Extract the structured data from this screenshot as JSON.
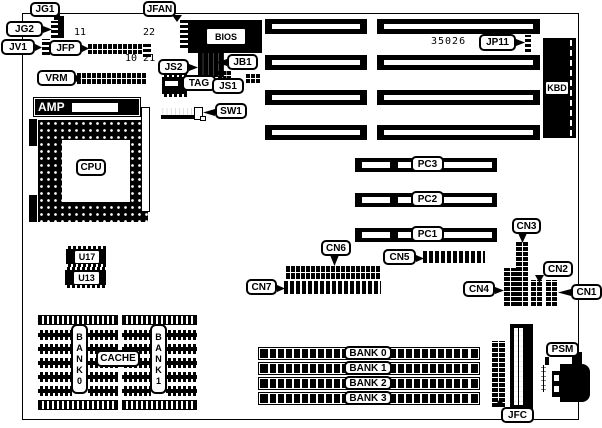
{
  "colors": {
    "ink": "#000000",
    "paper": "#ffffff"
  },
  "labels": {
    "jg1": "JG1",
    "jg2": "JG2",
    "jv1": "JV1",
    "jfp": "JFP",
    "vrm": "VRM",
    "amp": "AMP",
    "cpu": "CPU",
    "u17": "U17",
    "u13": "U13",
    "jfan": "JFAN",
    "bios": "BIOS",
    "js2": "JS2",
    "jb1": "JB1",
    "tag": "TAG",
    "js1": "JS1",
    "sw1": "SW1",
    "jp11": "JP11",
    "kbd": "KBD",
    "pc1": "PC1",
    "pc2": "PC2",
    "pc3": "PC3",
    "cn1": "CN1",
    "cn2": "CN2",
    "cn3": "CN3",
    "cn4": "CN4",
    "cn5": "CN5",
    "cn6": "CN6",
    "cn7": "CN7",
    "jfc": "JFC",
    "psm": "PSM",
    "cache": "CACHE",
    "bank0_column": "BANK0",
    "bank1_column": "BANK1",
    "chip_number": "35026"
  },
  "pin_numbers": {
    "jfp_pin11": "11",
    "jfp_pin22": "22",
    "jfp_pin10_21": "10 21"
  },
  "simm_banks": [
    "BANK 0",
    "BANK 1",
    "BANK 2",
    "BANK 3"
  ]
}
